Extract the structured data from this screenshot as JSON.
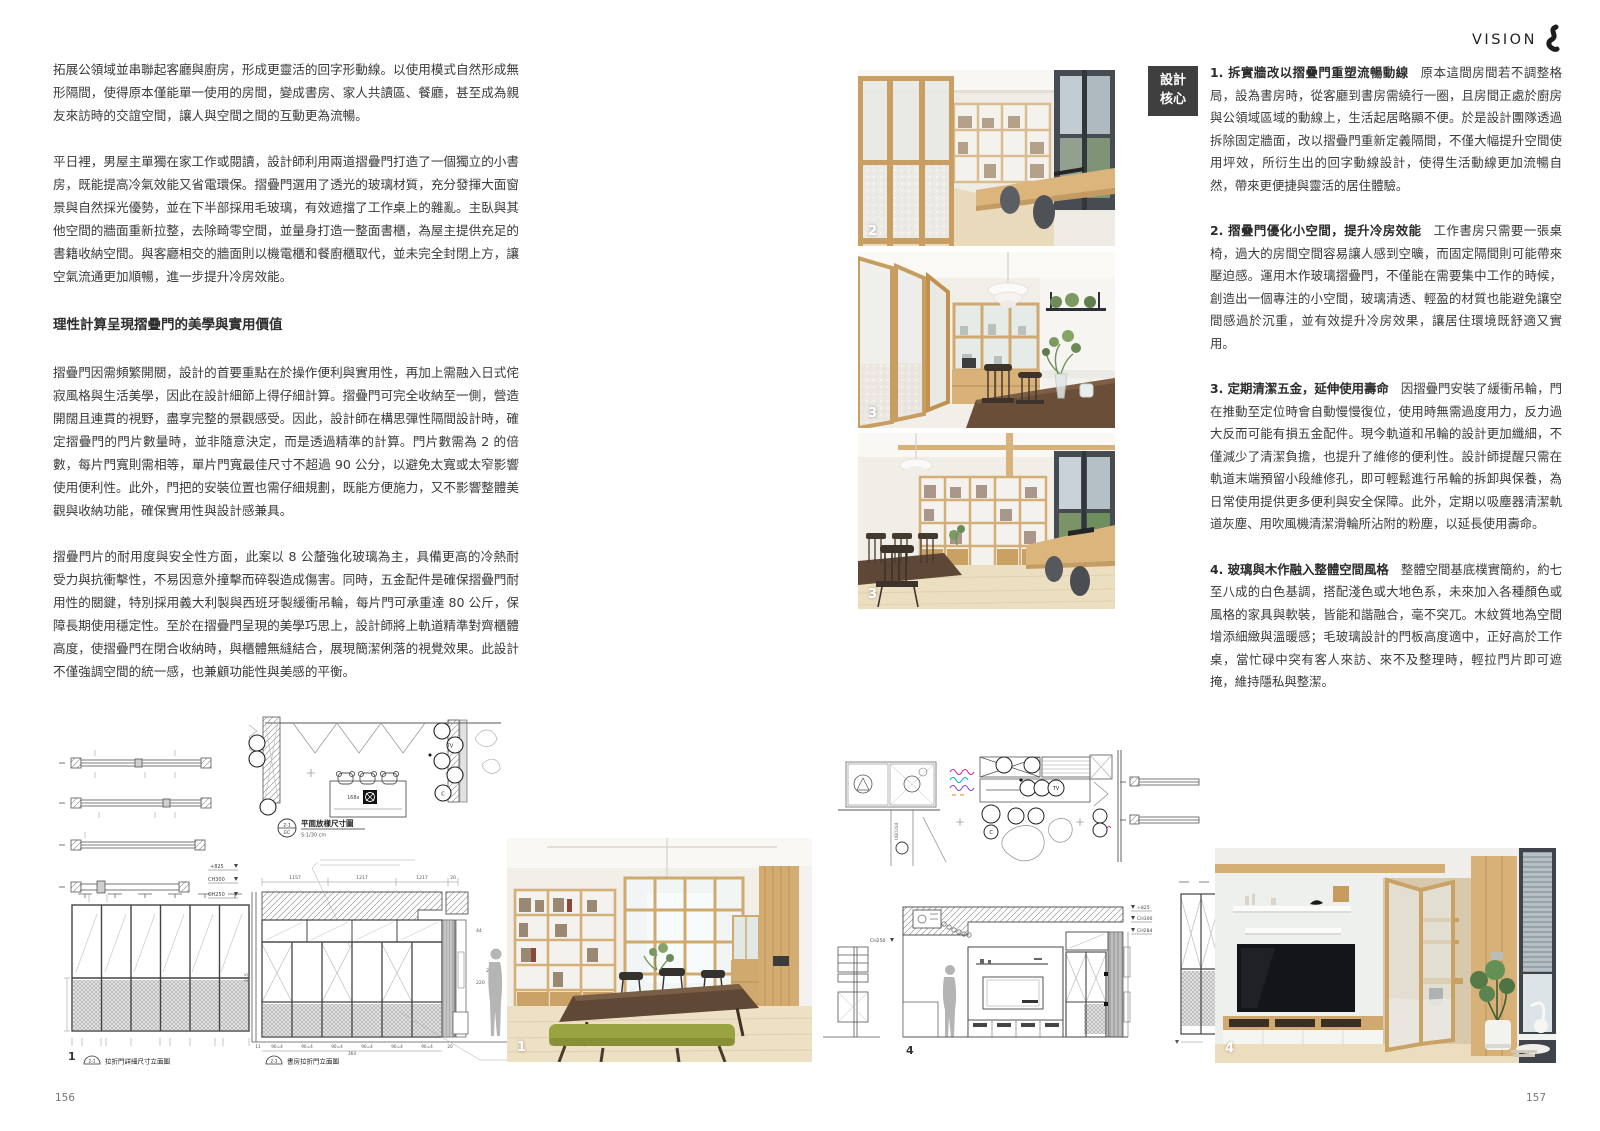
{
  "header": {
    "brand": "VISION"
  },
  "footer": {
    "left_page_number": "156",
    "right_page_number": "157"
  },
  "article": {
    "intro": [
      "拓展公領域並串聯起客廳與廚房，形成更靈活的回字形動線。以使用模式自然形成無形隔間，使得原本僅能單一使用的房間，變成書房、家人共讀區、餐廳，甚至成為親友來訪時的交誼空間，讓人與空間之間的互動更為流暢。",
      "平日裡，男屋主單獨在家工作或閱讀，設計師利用兩道摺疊門打造了一個獨立的小書房，既能提高冷氣效能又省電環保。摺疊門選用了透光的玻璃材質，充分發揮大面窗景與自然採光優勢，並在下半部採用毛玻璃，有效遮擋了工作桌上的雜亂。主臥與其他空間的牆面重新拉整，去除畸零空間，並量身打造一整面書櫃，為屋主提供充足的書籍收納空間。與客廳相交的牆面則以機電櫃和餐廚櫃取代，並未完全封閉上方，讓空氣流通更加順暢，進一步提升冷房效能。"
    ],
    "subheading": "理性計算呈現摺疊門的美學與實用價值",
    "body": [
      "摺疊門因需頻繁開關，設計的首要重點在於操作便利與實用性，再加上需融入日式侘寂風格與生活美學，因此在設計細節上得仔細計算。摺疊門可完全收納至一側，營造開闊且連貫的視野，盡享完整的景觀感受。因此，設計師在構思彈性隔間設計時，確定摺疊門的門片數量時，並非隨意決定，而是透過精準的計算。門片數需為 2 的倍數，每片門寬則需相等，單片門寬最佳尺寸不超過 90 公分，以避免太寬或太窄影響使用便利性。此外，門把的安裝位置也需仔細規劃，既能方便施力，又不影響整體美觀與收納功能，確保實用性與設計感兼具。",
      "摺疊門片的耐用度與安全性方面，此案以 8 公釐強化玻璃為主，具備更高的冷熱耐受力與抗衝擊性，不易因意外撞擊而碎裂造成傷害。同時，五金配件是確保摺疊門耐用性的關鍵，特別採用義大利製與西班牙製緩衝吊輪，每片門可承重達 80 公斤，保障長期使用穩定性。至於在摺疊門呈現的美學巧思上，設計師將上軌道精準對齊櫃體高度，使摺疊門在閉合收納時，與櫃體無縫結合，展現簡潔俐落的視覺效果。此設計不僅強調空間的統一感，也兼顧功能性與美感的平衡。"
    ]
  },
  "design_core": {
    "badge_line1": "設計",
    "badge_line2": "核心",
    "badge_color": "#3f3f3f",
    "points": [
      {
        "title": "1. 拆實牆改以摺疊門重塑流暢動線",
        "body": "原本這間房間若不調整格局，設為書房時，從客廳到書房需繞行一圈，且房間正處於廚房與公領域區域的動線上，生活起居略顯不便。於是設計團隊透過拆除固定牆面，改以摺疊門重新定義隔間，不僅大幅提升空間使用坪效，所衍生出的回字動線設計，使得生活動線更加流暢自然，帶來更便捷與靈活的居住體驗。"
      },
      {
        "title": "2. 摺疊門優化小空間，提升冷房效能",
        "body": "工作書房只需要一張桌椅，過大的房間空間容易讓人感到空曠，而固定隔間則可能帶來壓迫感。運用木作玻璃摺疊門，不僅能在需要集中工作的時候，創造出一個專注的小空間，玻璃清透、輕盈的材質也能避免讓空間感過於沉重，並有效提升冷房效果，讓居住環境既舒適又實用。"
      },
      {
        "title": "3. 定期清潔五金，延伸使用壽命",
        "body": "因摺疊門安裝了緩衝吊輪，門在推動至定位時會自動慢慢復位，使用時無需過度用力，反力過大反而可能有損五金配件。現今軌道和吊輪的設計更加纖細，不僅減少了清潔負擔，也提升了維修的便利性。設計師提醒只需在軌道末端預留小段維修孔，即可輕鬆進行吊輪的拆卸與保養，為日常使用提供更多便利與安全保障。此外，定期以吸塵器清潔軌道灰塵、用吹風機清潔滑輪所沾附的粉塵，以延長使用壽命。"
      },
      {
        "title": "4. 玻璃與木作融入整體空間風格",
        "body": "整體空間基底樸實簡約，約七至八成的白色基調，搭配淺色或大地色系，未來加入各種顏色或風格的家具與軟裝，皆能和諧融合，毫不突兀。木紋質地為空間增添細緻與溫暖感；毛玻璃設計的門板高度適中，正好高於工作桌，當忙碌中突有客人來訪、來不及整理時，輕拉門片即可遮掩，維持隱私與整潔。"
      }
    ]
  },
  "photos": {
    "p1": {
      "number": "1"
    },
    "p2": {
      "number": "2"
    },
    "p3a": {
      "number": "3"
    },
    "p3b": {
      "number": "3"
    },
    "p4": {
      "number": "4"
    }
  },
  "drawings": {
    "plan_left": {
      "ref_top": "2-1",
      "ref_bottom": "EC",
      "caption": "平面放樣尺寸圖",
      "scale": "S:1/30 cm",
      "table_tag": "168x",
      "tv_tag": "TV",
      "c_tag": "C"
    },
    "elev_detail": {
      "fig": "1",
      "ref": "2-1",
      "caption": "拉折門詳細尺寸立面圖"
    },
    "elev_study": {
      "ref": "2-1",
      "caption": "書房拉折門立面圖",
      "mark1": "+825",
      "mark2": "CH300",
      "mark3": "CH250",
      "dim1": "1157",
      "dim2": "1217",
      "dim3": "1217",
      "dim4": "20",
      "dim_left": "215",
      "dim_r1": "44",
      "dim_r2": "220",
      "dim_r3": "264",
      "dim_b0": "11",
      "dim_b": "90=4",
      "dim_b_end": "20",
      "dim_total": "364"
    },
    "plan_right": {
      "wall_tag": "UB0284",
      "tv_tag": "TV",
      "c_tag": "C"
    },
    "elev_tv": {
      "fig": "4",
      "mark_left": "CH250",
      "mark_r1": "+825",
      "mark_r2": "CH300",
      "mark_r3": "CH284"
    }
  }
}
